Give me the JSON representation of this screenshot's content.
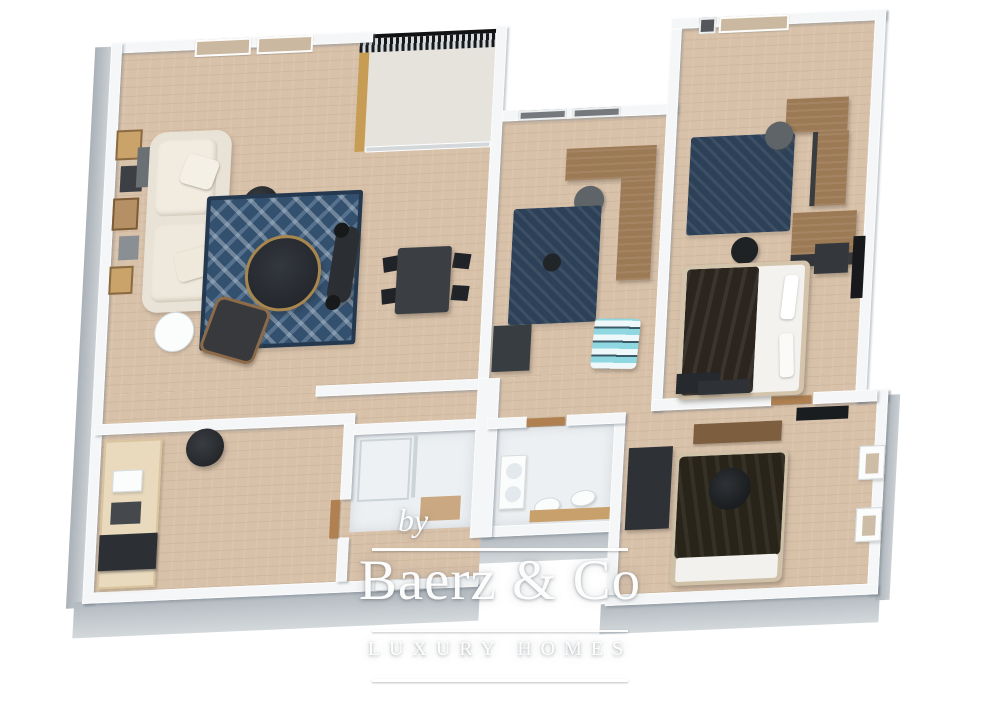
{
  "brand_watermark": {
    "prefix": "by",
    "name": "Baerz & Co",
    "tagline": "LUXURY HOMES"
  },
  "scene": {
    "description": "3D isometric floor plan rendering of an apartment",
    "background": "#ffffff"
  },
  "palette": {
    "wall": "#f4f6f7",
    "wall_shadow": "#c6cbd0",
    "floor_wood": "#d8c1a9",
    "floor_white": "#edf0f2",
    "rug_navy": "#33506e",
    "furniture_dark": "#2b2e33",
    "wood": "#9c7a55",
    "sofa_cream": "#e9e3d7",
    "pouf_teal": "#8fd8e2",
    "railing_black": "#17181a",
    "watermark_white": "#ffffff"
  },
  "rooms": [
    {
      "name": "living-room",
      "items": [
        "gallery-wall-frames",
        "sofa",
        "side-table",
        "floor-lamp",
        "patterned-rug",
        "round-coffee-table",
        "armchair",
        "exercise-bench",
        "dining-table",
        "dining-chairs",
        "windows",
        "balcony-doors"
      ]
    },
    {
      "name": "balcony",
      "items": [
        "railing",
        "glass-door",
        "wood-deck-strip"
      ]
    },
    {
      "name": "office",
      "items": [
        "desk",
        "office-chair",
        "rug",
        "door-mat",
        "striped-pouf",
        "windows"
      ]
    },
    {
      "name": "bedroom-1",
      "items": [
        "double-bed",
        "rug",
        "desk",
        "desk-chair",
        "wardrobe",
        "nightstand",
        "ottoman",
        "tv",
        "window",
        "bench"
      ]
    },
    {
      "name": "bedroom-2",
      "items": [
        "double-bed",
        "round-cushion",
        "dresser",
        "wall-panel",
        "tv",
        "windows"
      ]
    },
    {
      "name": "kitchen",
      "items": [
        "counter",
        "sink",
        "oven",
        "pendant-lamp"
      ]
    },
    {
      "name": "bathroom-shower",
      "items": [
        "shower-tray",
        "glass-panel",
        "wood-mat"
      ]
    },
    {
      "name": "bathroom-main",
      "items": [
        "vanity-basins",
        "toilet",
        "toilet",
        "wood-counter"
      ]
    }
  ]
}
